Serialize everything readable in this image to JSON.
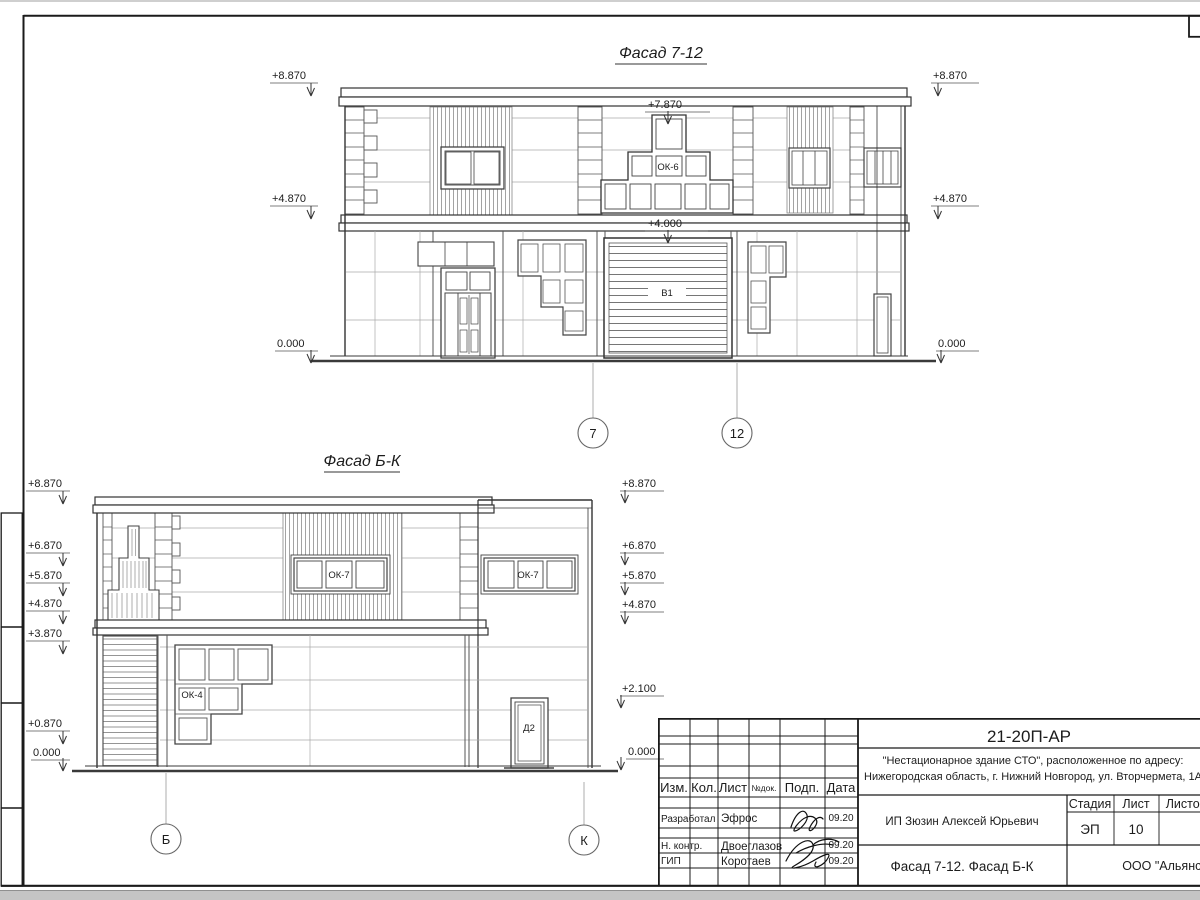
{
  "facade_top": {
    "title": "Фасад 7-12",
    "axes": {
      "left": "7",
      "right": "12"
    },
    "marks": {
      "m8870": "+8.870",
      "m7870": "+7.870",
      "m4870": "+4.870",
      "m4000": "+4.000",
      "m0000": "0.000"
    },
    "labels": {
      "ok6": "ОК-6",
      "v1": "В1"
    }
  },
  "facade_bottom": {
    "title": "Фасад Б-К",
    "axes": {
      "left": "Б",
      "right": "К"
    },
    "marks": {
      "m8870": "+8.870",
      "m6870": "+6.870",
      "m5870": "+5.870",
      "m4870": "+4.870",
      "m3870": "+3.870",
      "m2100": "+2.100",
      "m0870": "+0.870",
      "m0000": "0.000"
    },
    "labels": {
      "ok7": "ОК-7",
      "ok4": "ОК-4",
      "d2": "Д2"
    }
  },
  "title_block": {
    "doc_number": "21-20П-АР",
    "project_name_line1": "\"Нестационарное здание СТО\", расположенное по адресу:",
    "project_name_line2": "Нижегородская область, г. Нижний Новгород, ул. Вторчермета, 1А",
    "client": "ИП Зюзин Алексей Юрьевич",
    "drawing_title": "Фасад 7-12. Фасад Б-К",
    "company": "ООО \"Альянс\"",
    "stage": {
      "label": "Стадия",
      "value": "ЭП"
    },
    "sheet": {
      "label": "Лист",
      "value": "10"
    },
    "sheets": {
      "label": "Листов"
    },
    "columns": {
      "izm": "Изм.",
      "kol": "Кол.",
      "list": "Лист",
      "ndok": "№док.",
      "podp": "Подп.",
      "data": "Дата"
    },
    "signers": [
      {
        "role": "Разработал",
        "name": "Эфрос",
        "date": "09.20"
      },
      {
        "role": "Н. контр.",
        "name": "Двоеглазов",
        "date": "09.20"
      },
      {
        "role": "ГИП",
        "name": "Коротаев",
        "date": "09.20"
      }
    ]
  },
  "colors": {
    "line": "#2f2f2f",
    "light_line": "#a0a0a0",
    "paper": "#ffffff",
    "edge": "#c4c4c4"
  }
}
